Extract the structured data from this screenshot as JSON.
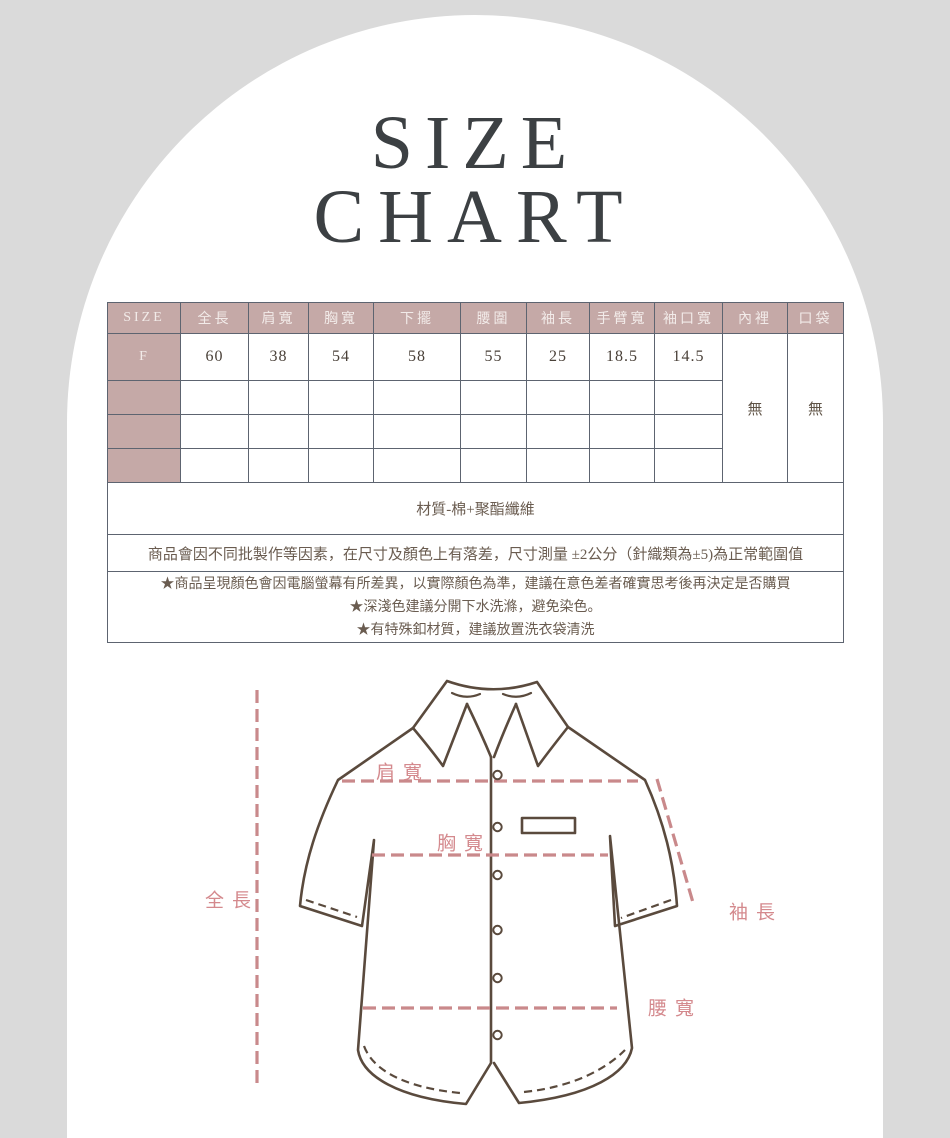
{
  "page": {
    "background_color": "#dadada",
    "arch_color": "#ffffff"
  },
  "title": {
    "line1": "SIZE",
    "line2": "CHART",
    "color": "#3c4043"
  },
  "size_table": {
    "header_bg": "#c5a9a7",
    "border_color": "#5d6470",
    "columns": [
      "SIZE",
      "全長",
      "肩寬",
      "胸寬",
      "下擺",
      "腰圍",
      "袖長",
      "手臂寬",
      "袖口寬",
      "內裡",
      "口袋"
    ],
    "rows": [
      {
        "size": "F",
        "values": [
          "60",
          "38",
          "54",
          "58",
          "55",
          "25",
          "18.5",
          "14.5"
        ],
        "lining": "無",
        "pocket": "無"
      },
      {
        "size": "",
        "values": [
          "",
          "",
          "",
          "",
          "",
          "",
          "",
          ""
        ]
      },
      {
        "size": "",
        "values": [
          "",
          "",
          "",
          "",
          "",
          "",
          "",
          ""
        ]
      },
      {
        "size": "",
        "values": [
          "",
          "",
          "",
          "",
          "",
          "",
          "",
          ""
        ]
      }
    ],
    "material": "材質-棉+聚酯纖維",
    "notice": "商品會因不同批製作等因素，在尺寸及顏色上有落差，尺寸測量 ±2公分（針織類為±5)為正常範圍值",
    "notes": [
      "★商品呈現顏色會因電腦螢幕有所差異，以實際顏色為準，建議在意色差者確實思考後再決定是否購買",
      "★深淺色建議分開下水洗滌，避免染色。",
      "★有特殊釦材質，建議放置洗衣袋清洗"
    ]
  },
  "diagram": {
    "labels": {
      "shoulder": "肩寬",
      "chest": "胸寬",
      "length": "全長",
      "sleeve": "袖長",
      "waist": "腰寬"
    },
    "label_color": "#d4898d",
    "dash_color": "#c9898b",
    "outline_color": "#5a4a3d"
  }
}
